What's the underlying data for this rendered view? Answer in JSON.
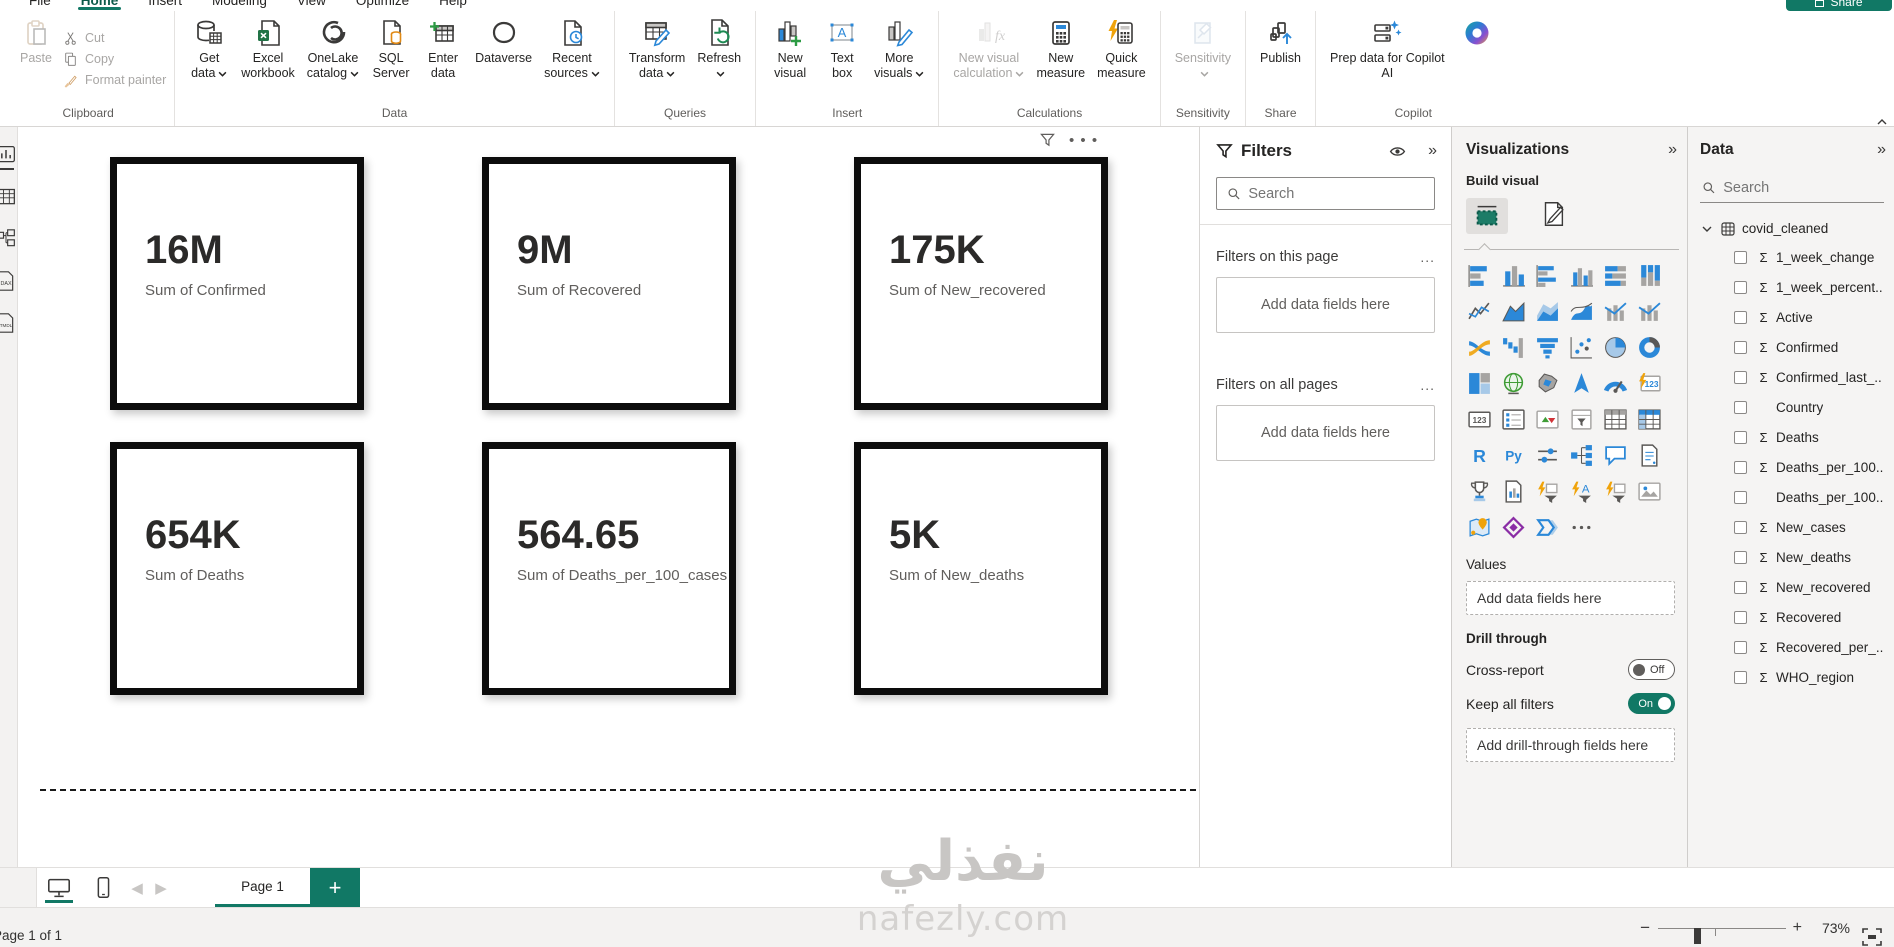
{
  "app": {
    "accent": "#117865",
    "share_label": "Share"
  },
  "menu": {
    "items": [
      "File",
      "Home",
      "Insert",
      "Modeling",
      "View",
      "Optimize",
      "Help"
    ],
    "active_index": 1
  },
  "ribbon": {
    "groups": [
      {
        "label": "Clipboard",
        "kind": "clipboard",
        "big": {
          "label_lines": [
            "Paste"
          ],
          "icon": "paste",
          "disabled": true
        },
        "small": [
          {
            "label": "Cut",
            "icon": "cut",
            "disabled": true
          },
          {
            "label": "Copy",
            "icon": "copy",
            "disabled": true
          },
          {
            "label": "Format painter",
            "icon": "format-painter",
            "disabled": true
          }
        ]
      },
      {
        "label": "Data",
        "buttons": [
          {
            "label_lines": [
              "Get",
              "data"
            ],
            "icon": "get-data",
            "caret": true
          },
          {
            "label_lines": [
              "Excel",
              "workbook"
            ],
            "icon": "excel-workbook"
          },
          {
            "label_lines": [
              "OneLake",
              "catalog"
            ],
            "icon": "onelake-catalog",
            "caret": true
          },
          {
            "label_lines": [
              "SQL",
              "Server"
            ],
            "icon": "sql-server"
          },
          {
            "label_lines": [
              "Enter",
              "data"
            ],
            "icon": "enter-data"
          },
          {
            "label_lines": [
              "Dataverse"
            ],
            "icon": "dataverse"
          },
          {
            "label_lines": [
              "Recent",
              "sources"
            ],
            "icon": "recent-sources",
            "caret": true
          }
        ]
      },
      {
        "label": "Queries",
        "buttons": [
          {
            "label_lines": [
              "Transform",
              "data"
            ],
            "icon": "transform-data",
            "caret": true
          },
          {
            "label_lines": [
              "Refresh",
              ""
            ],
            "icon": "refresh",
            "caret": true
          }
        ]
      },
      {
        "label": "Insert",
        "buttons": [
          {
            "label_lines": [
              "New",
              "visual"
            ],
            "icon": "new-visual"
          },
          {
            "label_lines": [
              "Text",
              "box"
            ],
            "icon": "text-box"
          },
          {
            "label_lines": [
              "More",
              "visuals"
            ],
            "icon": "more-visuals",
            "caret": true
          }
        ]
      },
      {
        "label": "Calculations",
        "buttons": [
          {
            "label_lines": [
              "New visual",
              "calculation"
            ],
            "icon": "new-visual-calculation",
            "caret": true,
            "disabled": true
          },
          {
            "label_lines": [
              "New",
              "measure"
            ],
            "icon": "new-measure"
          },
          {
            "label_lines": [
              "Quick",
              "measure"
            ],
            "icon": "quick-measure"
          }
        ]
      },
      {
        "label": "Sensitivity",
        "buttons": [
          {
            "label_lines": [
              "Sensitivity",
              ""
            ],
            "icon": "sensitivity",
            "caret": true,
            "disabled": true
          }
        ]
      },
      {
        "label": "Share",
        "buttons": [
          {
            "label_lines": [
              "Publish"
            ],
            "icon": "publish"
          }
        ]
      },
      {
        "label": "Copilot",
        "buttons": [
          {
            "label_lines": [
              "Prep data for Copilot",
              "AI"
            ],
            "icon": "prep-copilot"
          },
          {
            "label_lines": [],
            "icon": "copilot-logo"
          }
        ]
      }
    ]
  },
  "canvas": {
    "cards": [
      {
        "value": "16M",
        "label": "Sum of Confirmed"
      },
      {
        "value": "9M",
        "label": "Sum of Recovered"
      },
      {
        "value": "175K",
        "label": "Sum of New_recovered"
      },
      {
        "value": "654K",
        "label": "Sum of Deaths"
      },
      {
        "value": "564.65",
        "label": "Sum of Deaths_per_100_cases"
      },
      {
        "value": "5K",
        "label": "Sum of New_deaths"
      }
    ],
    "watermark_line1": "نفذلي",
    "watermark_line2": "nafezly.com"
  },
  "filters": {
    "title": "Filters",
    "search_placeholder": "Search",
    "section_page": "Filters on this page",
    "section_all": "Filters on all pages",
    "add_hint": "Add data fields here",
    "more_label": "..."
  },
  "visualizations": {
    "title": "Visualizations",
    "build_label": "Build visual",
    "values_label": "Values",
    "values_hint": "Add data fields here",
    "drill_label": "Drill through",
    "cross_report_label": "Cross-report",
    "cross_report_state": "Off",
    "keep_filters_label": "Keep all filters",
    "keep_filters_state": "On",
    "drill_hint": "Add drill-through fields here",
    "gallery": [
      {
        "name": "stacked-bar-chart",
        "kind": "hbars"
      },
      {
        "name": "stacked-column-chart",
        "kind": "vbars"
      },
      {
        "name": "clustered-bar-chart",
        "kind": "hbars2"
      },
      {
        "name": "clustered-column-chart",
        "kind": "vbars2"
      },
      {
        "name": "hundred-stacked-bar-chart",
        "kind": "hbars100"
      },
      {
        "name": "hundred-stacked-column-chart",
        "kind": "vbars100"
      },
      {
        "name": "line-chart",
        "kind": "line"
      },
      {
        "name": "area-chart",
        "kind": "area"
      },
      {
        "name": "stacked-area-chart",
        "kind": "sarea"
      },
      {
        "name": "hundred-stacked-area-chart",
        "kind": "wave"
      },
      {
        "name": "line-and-stacked-column-chart",
        "kind": "combo"
      },
      {
        "name": "line-and-clustered-column-chart",
        "kind": "combo"
      },
      {
        "name": "ribbon-chart",
        "kind": "ribbon"
      },
      {
        "name": "waterfall-chart",
        "kind": "waterfall"
      },
      {
        "name": "funnel-chart",
        "kind": "funnel"
      },
      {
        "name": "scatter-chart",
        "kind": "scatter"
      },
      {
        "name": "pie-chart",
        "kind": "pie"
      },
      {
        "name": "donut-chart",
        "kind": "donut"
      },
      {
        "name": "treemap",
        "kind": "treemap"
      },
      {
        "name": "map",
        "kind": "globe"
      },
      {
        "name": "filled-map",
        "kind": "shapemap"
      },
      {
        "name": "azure-map",
        "kind": "arrow"
      },
      {
        "name": "gauge",
        "kind": "gauge"
      },
      {
        "name": "card-new",
        "kind": "bolt123"
      },
      {
        "name": "card",
        "kind": "card123"
      },
      {
        "name": "multi-row-card",
        "kind": "mcard"
      },
      {
        "name": "kpi",
        "kind": "kpi"
      },
      {
        "name": "slicer",
        "kind": "slicer"
      },
      {
        "name": "table",
        "kind": "table"
      },
      {
        "name": "matrix",
        "kind": "matrix"
      },
      {
        "name": "r-script-visual",
        "kind": "R"
      },
      {
        "name": "python-visual",
        "kind": "Py"
      },
      {
        "name": "parameter-slicer",
        "kind": "params"
      },
      {
        "name": "decomposition-tree",
        "kind": "dtree"
      },
      {
        "name": "qa-visual",
        "kind": "qa"
      },
      {
        "name": "smart-narrative",
        "kind": "doc"
      },
      {
        "name": "metrics",
        "kind": "trophy"
      },
      {
        "name": "paginated-report",
        "kind": "pagereport"
      },
      {
        "name": "power-apps-premium",
        "kind": "boltfunnel"
      },
      {
        "name": "premium-text-visual",
        "kind": "boltA"
      },
      {
        "name": "premium-filter-visual",
        "kind": "boltfunnel"
      },
      {
        "name": "image-visual",
        "kind": "photo"
      },
      {
        "name": "arcgis-map",
        "kind": "arcgis"
      },
      {
        "name": "power-apps",
        "kind": "padiamond"
      },
      {
        "name": "power-automate",
        "kind": "flow"
      },
      {
        "name": "more-visuals-ellipsis",
        "kind": "dots"
      }
    ]
  },
  "data_pane": {
    "title": "Data",
    "search_placeholder": "Search",
    "table_name": "covid_cleaned",
    "fields": [
      {
        "name": "1_week_change",
        "sigma": true
      },
      {
        "name": "1_week_percent..",
        "sigma": true
      },
      {
        "name": "Active",
        "sigma": true
      },
      {
        "name": "Confirmed",
        "sigma": true
      },
      {
        "name": "Confirmed_last_..",
        "sigma": true
      },
      {
        "name": "Country",
        "sigma": false
      },
      {
        "name": "Deaths",
        "sigma": true
      },
      {
        "name": "Deaths_per_100..",
        "sigma": true
      },
      {
        "name": "Deaths_per_100..",
        "sigma": false
      },
      {
        "name": "New_cases",
        "sigma": true
      },
      {
        "name": "New_deaths",
        "sigma": true
      },
      {
        "name": "New_recovered",
        "sigma": true
      },
      {
        "name": "Recovered",
        "sigma": true
      },
      {
        "name": "Recovered_per_...",
        "sigma": true
      },
      {
        "name": "WHO_region",
        "sigma": true
      }
    ]
  },
  "pagebar": {
    "tab": "Page 1",
    "add_label": "+"
  },
  "statusbar": {
    "page_info": "Page 1 of 1",
    "zoom": "73%"
  }
}
